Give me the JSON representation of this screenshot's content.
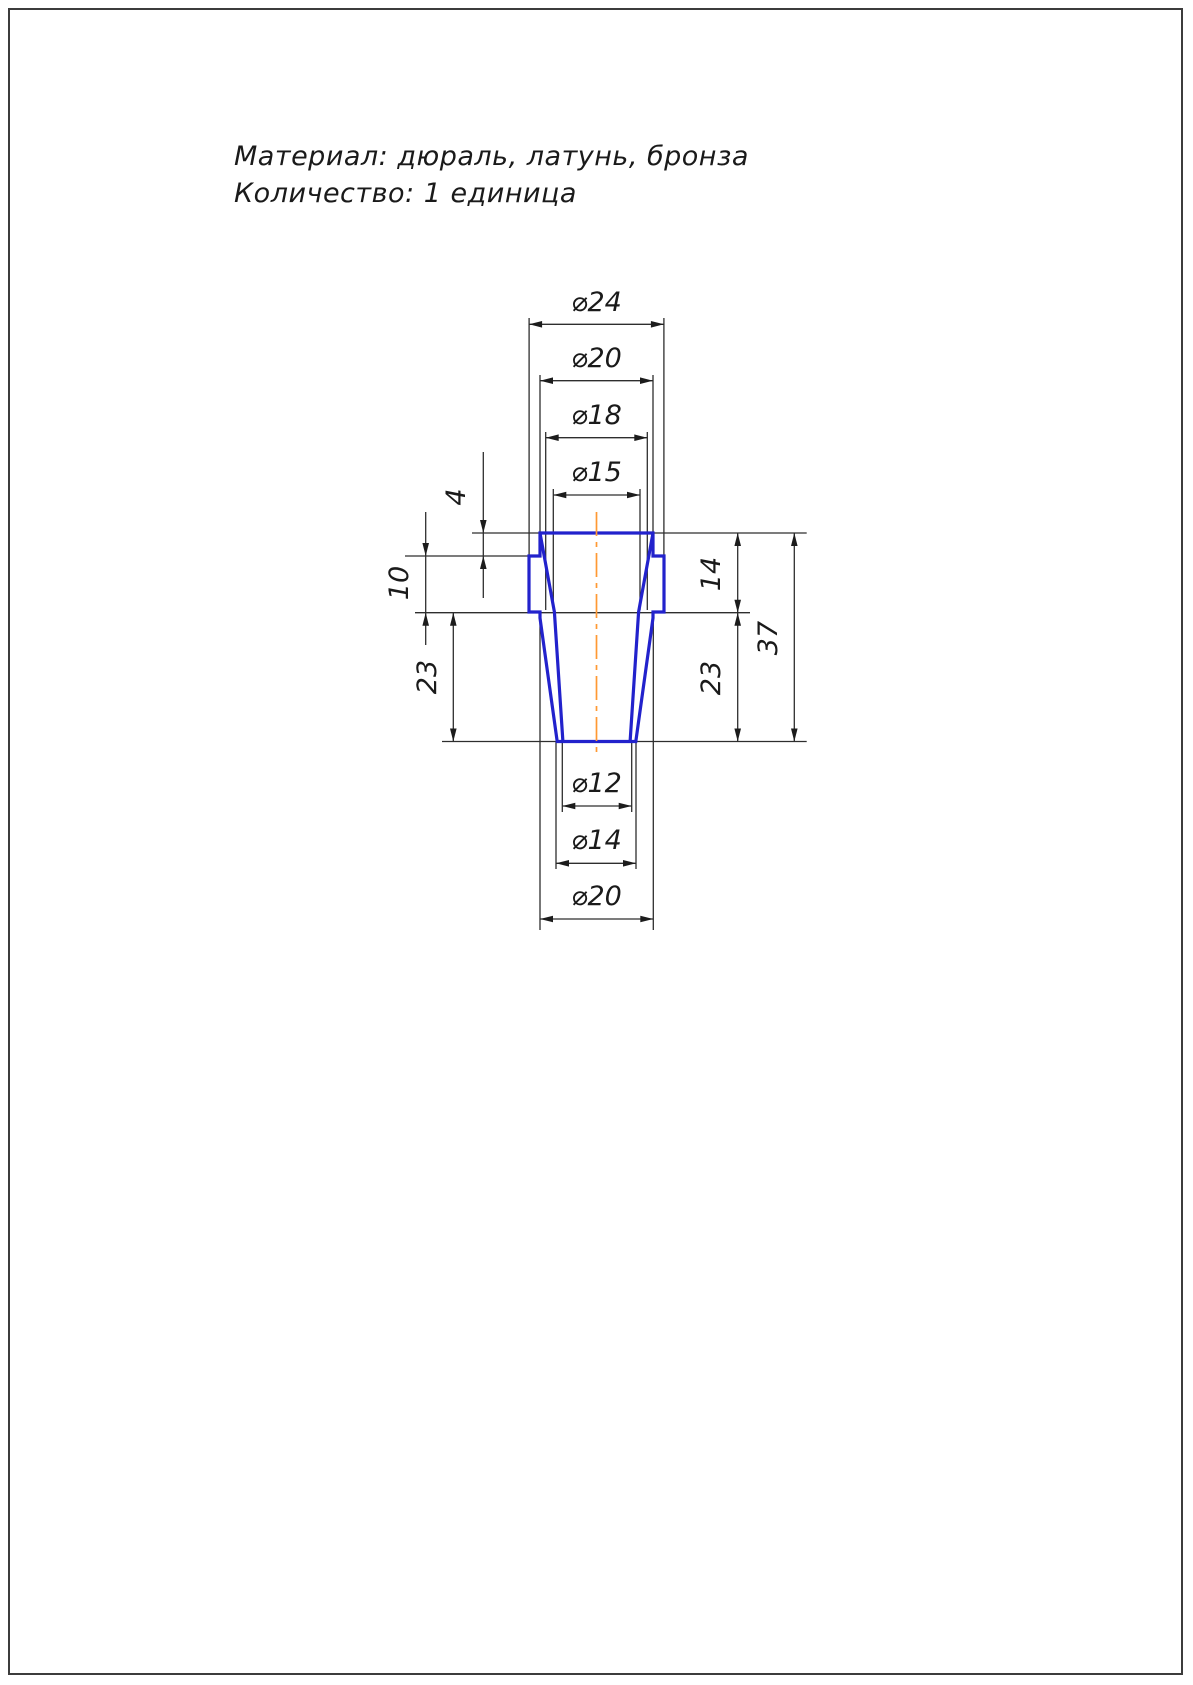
{
  "notes": {
    "line1": "Материал: дюраль, латунь, бронза",
    "line2": "Количество: 1 единица"
  },
  "colors": {
    "part_outline": "#2222cc",
    "centerline": "#ff9933",
    "dimension_lines": "#2e2e2e",
    "text": "#1a1a1a",
    "page_border": "#3c3c3c",
    "background": "#ffffff"
  },
  "drawing": {
    "center_x": 596.5,
    "part": {
      "outline": [
        [
          540,
          533
        ],
        [
          653,
          533
        ],
        [
          653,
          556
        ],
        [
          664,
          556
        ],
        [
          664,
          612
        ],
        [
          653,
          612
        ],
        [
          653,
          618
        ],
        [
          635.8,
          741.5
        ],
        [
          557.2,
          741.5
        ],
        [
          540,
          618
        ],
        [
          540,
          612
        ],
        [
          529,
          612
        ],
        [
          529,
          556
        ],
        [
          540,
          556
        ]
      ],
      "inner_left": [
        [
          540,
          533
        ],
        [
          554.4,
          612
        ],
        [
          562.9,
          741.5
        ]
      ],
      "inner_right": [
        [
          653,
          533
        ],
        [
          638.6,
          612
        ],
        [
          630.1,
          741.5
        ]
      ],
      "centerline": {
        "x": 596.5,
        "y1": 512,
        "y2": 753
      }
    },
    "ext_lines": [
      {
        "x1": 529.1,
        "y1": 318,
        "x2": 529.1,
        "y2": 556
      },
      {
        "x1": 663.9,
        "y1": 318,
        "x2": 663.9,
        "y2": 556
      },
      {
        "x1": 540,
        "y1": 375,
        "x2": 540,
        "y2": 533
      },
      {
        "x1": 653,
        "y1": 375,
        "x2": 653,
        "y2": 533
      },
      {
        "x1": 545.7,
        "y1": 432,
        "x2": 545.7,
        "y2": 610
      },
      {
        "x1": 647.3,
        "y1": 432,
        "x2": 647.3,
        "y2": 610
      },
      {
        "x1": 553.3,
        "y1": 489,
        "x2": 553.3,
        "y2": 610
      },
      {
        "x1": 640,
        "y1": 489,
        "x2": 640,
        "y2": 610
      },
      {
        "x1": 562.3,
        "y1": 741.5,
        "x2": 562.3,
        "y2": 812
      },
      {
        "x1": 631.7,
        "y1": 741.5,
        "x2": 631.7,
        "y2": 812
      },
      {
        "x1": 556,
        "y1": 741.5,
        "x2": 556,
        "y2": 869
      },
      {
        "x1": 636,
        "y1": 741.5,
        "x2": 636,
        "y2": 869
      },
      {
        "x1": 540,
        "y1": 618,
        "x2": 540,
        "y2": 930
      },
      {
        "x1": 653.3,
        "y1": 618,
        "x2": 653.3,
        "y2": 930
      },
      {
        "x1": 472,
        "y1": 533,
        "x2": 540,
        "y2": 533
      },
      {
        "x1": 653,
        "y1": 533,
        "x2": 806.7,
        "y2": 533
      },
      {
        "x1": 405,
        "y1": 556,
        "x2": 529,
        "y2": 556
      },
      {
        "x1": 415,
        "y1": 612.7,
        "x2": 750,
        "y2": 612.7
      },
      {
        "x1": 442,
        "y1": 741.5,
        "x2": 806.7,
        "y2": 741.5
      }
    ],
    "dims_h": [
      {
        "id": "d24",
        "label": "⌀24",
        "y": 324.3,
        "x1": 529.1,
        "x2": 663.9,
        "label_x": 596.5,
        "label_y": 311
      },
      {
        "id": "d20t",
        "label": "⌀20",
        "y": 380.7,
        "x1": 540,
        "x2": 653,
        "label_x": 596.5,
        "label_y": 367
      },
      {
        "id": "d18",
        "label": "⌀18",
        "y": 437.7,
        "x1": 545.7,
        "x2": 647.3,
        "label_x": 596.5,
        "label_y": 424
      },
      {
        "id": "d15",
        "label": "⌀15",
        "y": 495,
        "x1": 553.3,
        "x2": 640,
        "label_x": 596.5,
        "label_y": 481
      },
      {
        "id": "d12",
        "label": "⌀12",
        "y": 806,
        "x1": 562.3,
        "x2": 631.7,
        "label_x": 596.5,
        "label_y": 792
      },
      {
        "id": "d14b",
        "label": "⌀14",
        "y": 863.3,
        "x1": 556,
        "x2": 636,
        "label_x": 596.5,
        "label_y": 849
      },
      {
        "id": "d20b",
        "label": "⌀20",
        "y": 919,
        "x1": 540,
        "x2": 653.3,
        "label_x": 596.5,
        "label_y": 905
      }
    ],
    "dims_v": [
      {
        "id": "v4",
        "label": "4",
        "x": 483.3,
        "y1": 533,
        "y2": 556,
        "arrows": "outside",
        "line_y1": 452,
        "line_y2": 598,
        "label_x": 465,
        "label_y": 497
      },
      {
        "id": "v10",
        "label": "10",
        "x": 425.7,
        "y1": 556,
        "y2": 612.7,
        "arrows": "outside",
        "line_y1": 512,
        "line_y2": 645,
        "label_x": 408,
        "label_y": 583
      },
      {
        "id": "v23l",
        "label": "23",
        "x": 453.3,
        "y1": 612.7,
        "y2": 741.5,
        "arrows": "inside",
        "line_y1": 612.7,
        "line_y2": 741.5,
        "label_x": 436,
        "label_y": 677
      },
      {
        "id": "v14r",
        "label": "14",
        "x": 737.7,
        "y1": 533,
        "y2": 612.7,
        "arrows": "inside",
        "line_y1": 533,
        "line_y2": 612.7,
        "label_x": 720,
        "label_y": 574
      },
      {
        "id": "v23r",
        "label": "23",
        "x": 737.7,
        "y1": 612.7,
        "y2": 741.5,
        "arrows": "inside",
        "line_y1": 612.7,
        "line_y2": 741.5,
        "label_x": 720,
        "label_y": 678
      },
      {
        "id": "v37",
        "label": "37",
        "x": 794.3,
        "y1": 533,
        "y2": 741.5,
        "arrows": "inside",
        "line_y1": 533,
        "line_y2": 741.5,
        "label_x": 777,
        "label_y": 638
      }
    ]
  }
}
